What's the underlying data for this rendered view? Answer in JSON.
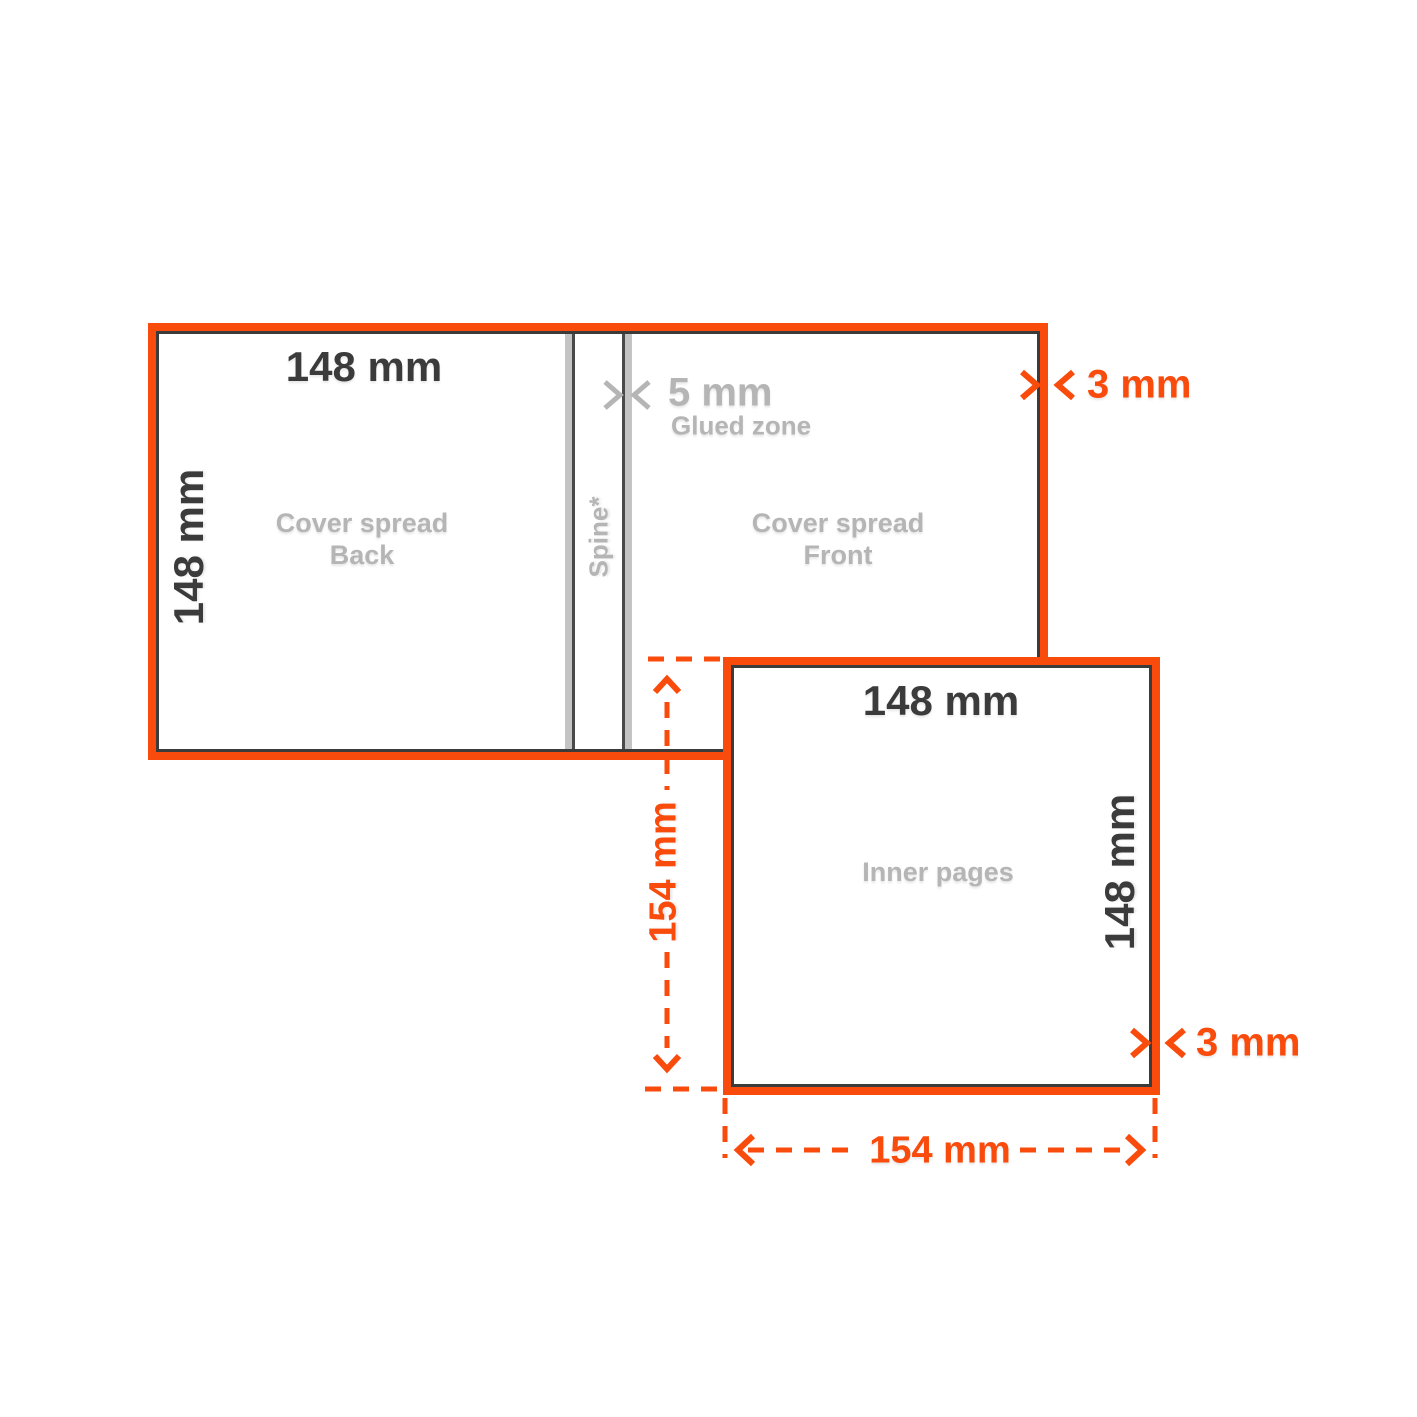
{
  "diagram": {
    "cover_spread": {
      "width_label": "148 mm",
      "height_label": "148 mm",
      "back_label": [
        "Cover spread",
        "Back"
      ],
      "front_label": [
        "Cover spread",
        "Front"
      ],
      "spine_label": "Spine*",
      "glued_zone_value": "5 mm",
      "glued_zone_label": "Glued zone",
      "bleed_label": "3 mm"
    },
    "inner_pages": {
      "label": "Inner pages",
      "width_label": "148 mm",
      "height_label": "148 mm",
      "bleed_label": "3 mm",
      "total_width_label": "154 mm",
      "total_height_label": "154 mm"
    },
    "colors": {
      "accent_orange": "#F94B0C",
      "trim_dark": "#3B3B3B",
      "muted_gray": "#B5B5B5",
      "fold_bar_gray": "#C4C4C4"
    }
  }
}
